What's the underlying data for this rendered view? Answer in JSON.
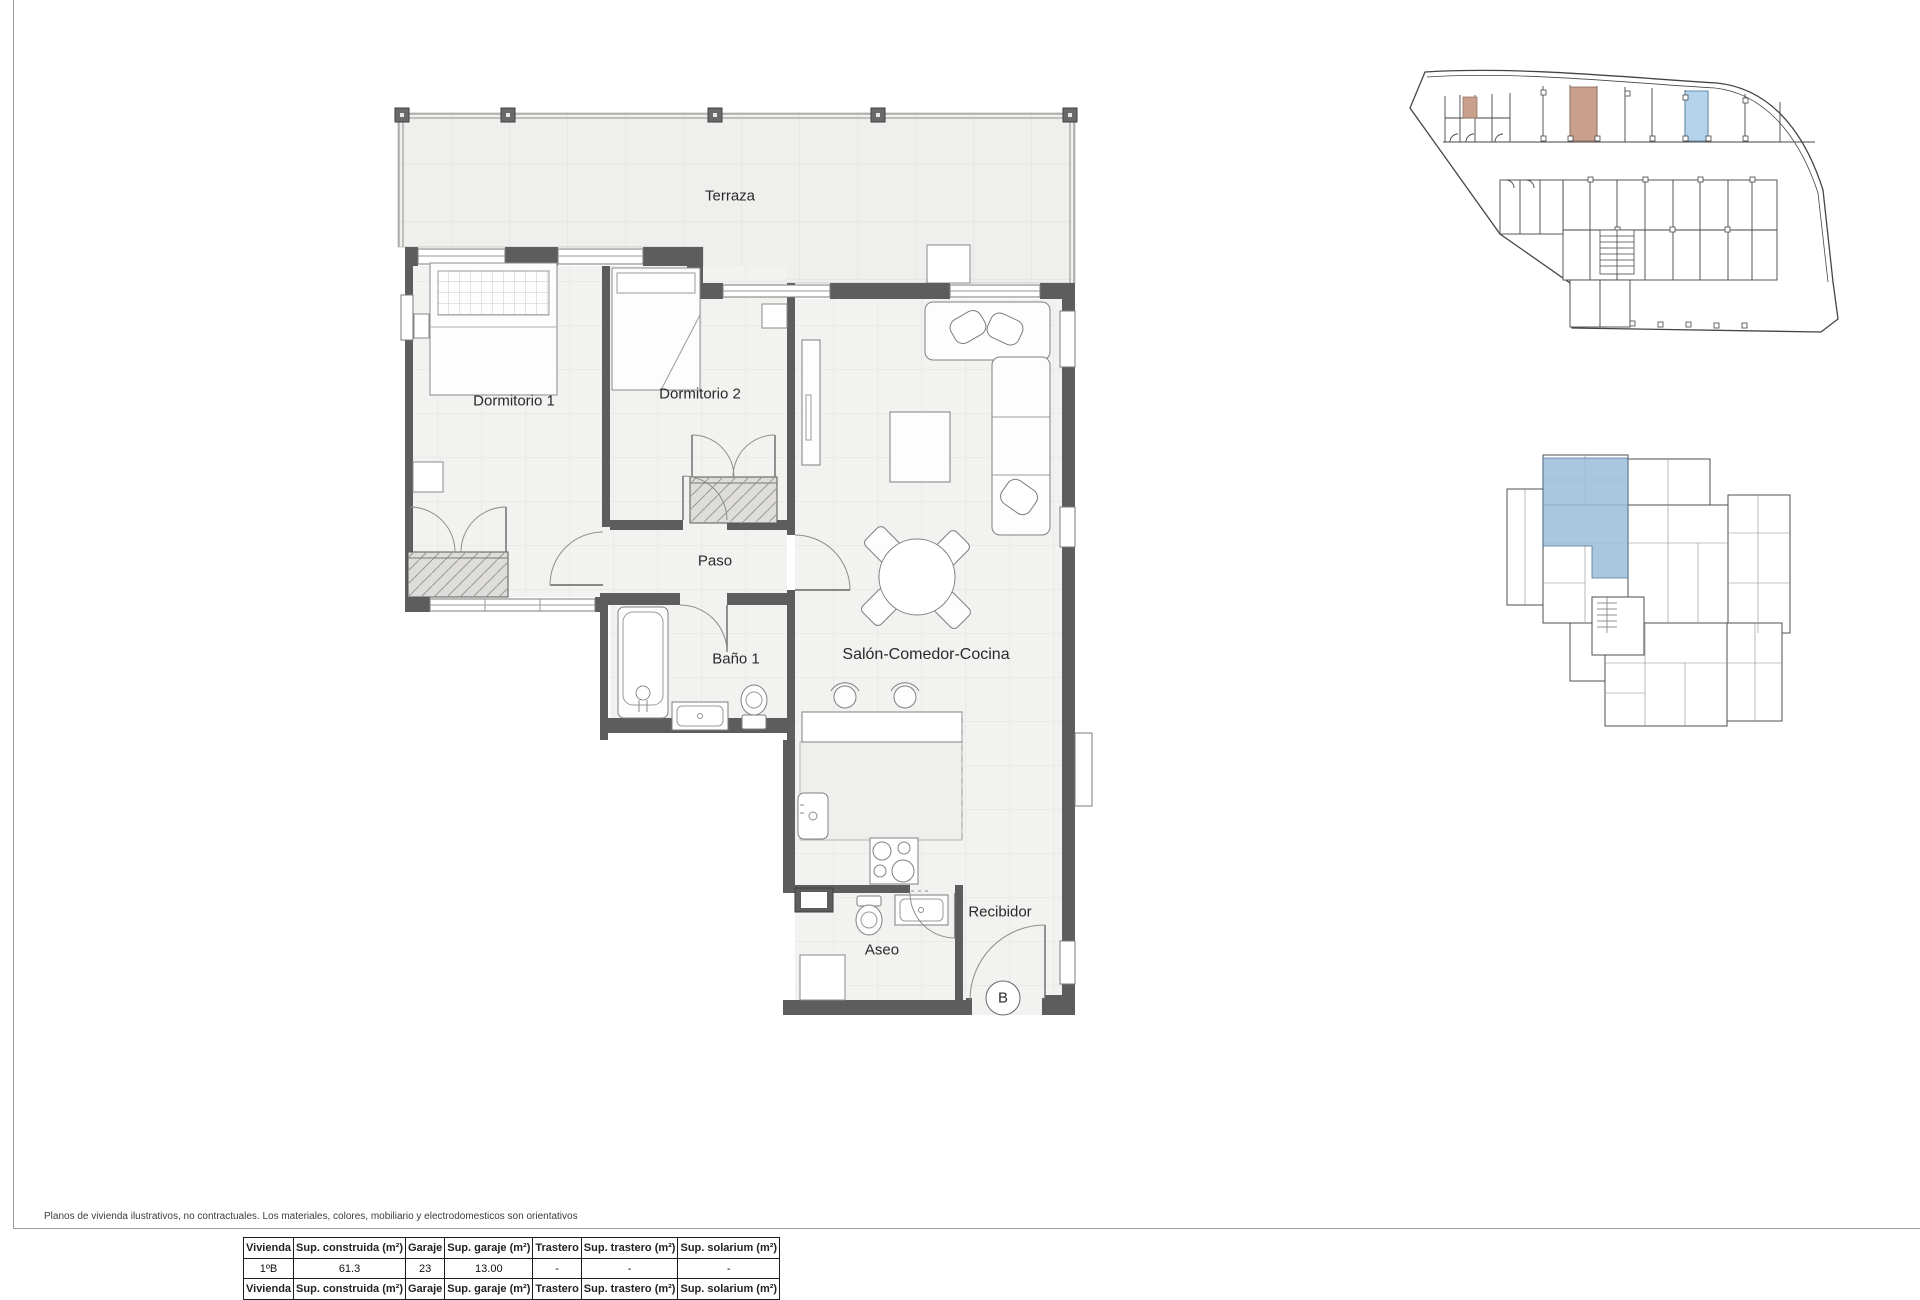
{
  "disclaimer": "Planos de vivienda ilustrativos, no contractuales. Los materiales, colores, mobiliario y electrodomesticos son orientativos",
  "floor_plan": {
    "labels": {
      "terraza": "Terraza",
      "dormitorio1": "Dormitorio 1",
      "dormitorio2": "Dormitorio 2",
      "paso": "Paso",
      "bano1": "Baño 1",
      "salon": "Salón-Comedor-Cocina",
      "aseo": "Aseo",
      "recibidor": "Recibidor"
    },
    "unit_marker": "B"
  },
  "summary_table": {
    "headers": [
      "Vivienda",
      "Sup. construida (m²)",
      "Garaje",
      "Sup. garaje (m²)",
      "Trastero",
      "Sup. trastero (m²)",
      "Sup. solarium (m²)"
    ],
    "rows": [
      [
        "1ºB",
        "61.3",
        "23",
        "13.00",
        "-",
        "-",
        "-"
      ]
    ]
  },
  "colors": {
    "highlight_blue": "#b5d4ec",
    "highlight_tan": "#c9a08c",
    "keyplan_blue": "#9cbeda",
    "wall_gray": "#5d5d5d"
  }
}
